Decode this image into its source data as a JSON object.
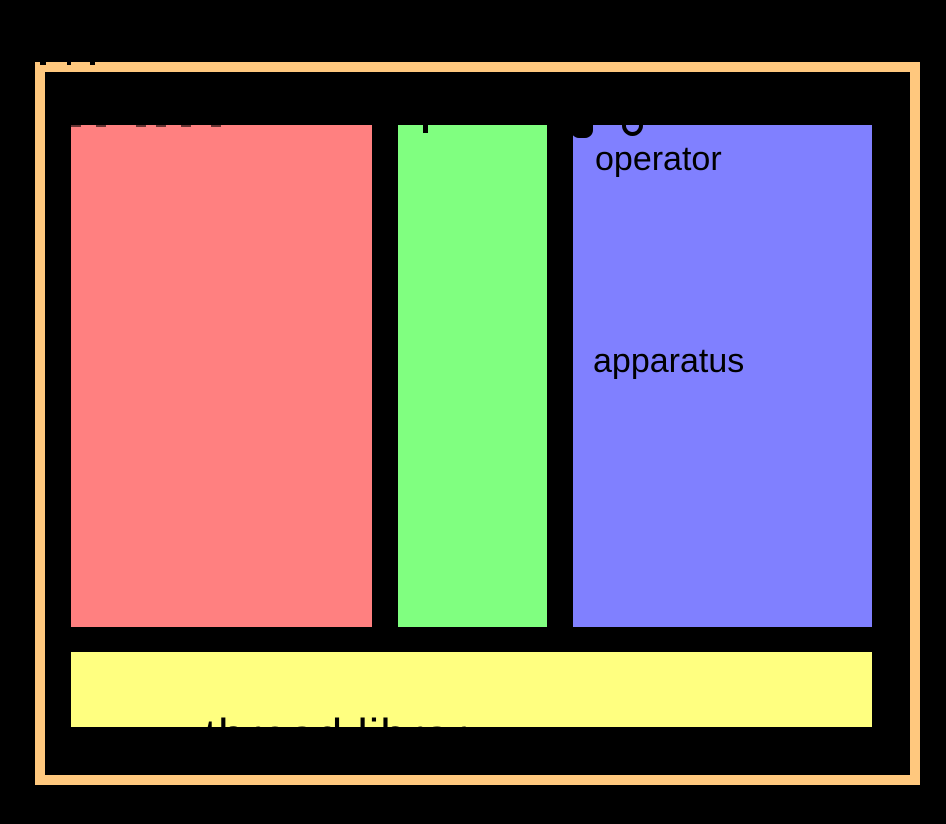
{
  "canvas": {
    "width": 946,
    "height": 824,
    "background": "#000000"
  },
  "palette": {
    "frame_orange": "#ffc87e",
    "left_box_red": "#ff8080",
    "middle_box_green": "#80ff80",
    "right_box_blue": "#8080ff",
    "bottom_bar_yellow": "#ffff80",
    "text_black": "#000000"
  },
  "diagram": {
    "right_box_labels": [
      "operator",
      "apparatus"
    ],
    "bottom_bar_label": "thread library"
  }
}
